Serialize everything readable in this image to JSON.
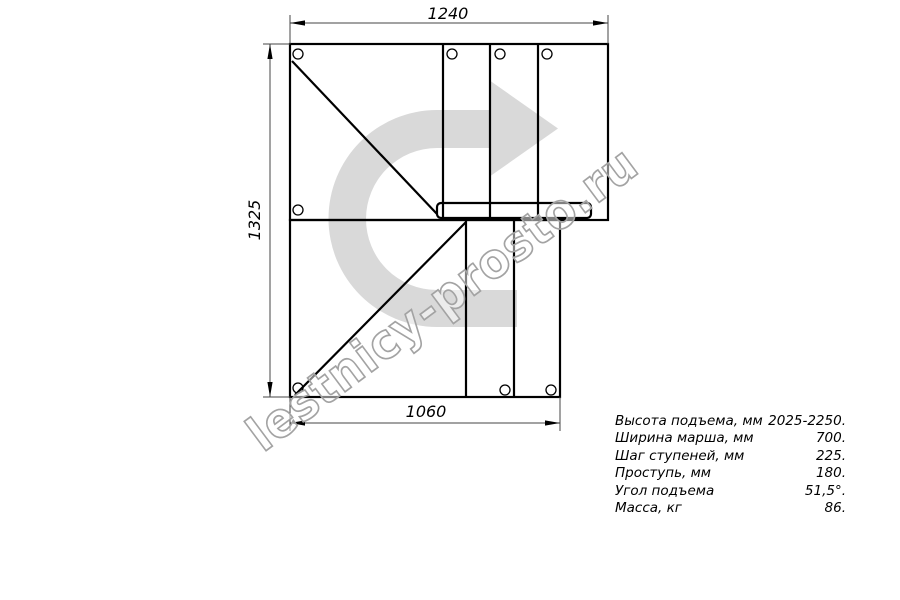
{
  "drawing": {
    "type": "staircase-plan-technical-drawing",
    "dimensions": {
      "top": "1240",
      "left": "1325",
      "bottom": "1060"
    },
    "line_color": "#000000",
    "dim_line_color": "#444444"
  },
  "watermark": {
    "text": "lestnicy-prosto.ru",
    "arrow_color": "#d9d9d9",
    "text_outline_color": "#a3a3a3",
    "text_fill_color": "rgba(255,255,255,0.5)"
  },
  "specs": {
    "rows": [
      {
        "label": "Высота подъема, мм",
        "value": "2025-2250."
      },
      {
        "label": "Ширина марша, мм",
        "value": "700."
      },
      {
        "label": "Шаг ступеней, мм",
        "value": "225."
      },
      {
        "label": "Проступь, мм",
        "value": "180."
      },
      {
        "label": "Угол подъема",
        "value": "51,5°."
      },
      {
        "label": "Масса, кг",
        "value": "86."
      }
    ]
  }
}
